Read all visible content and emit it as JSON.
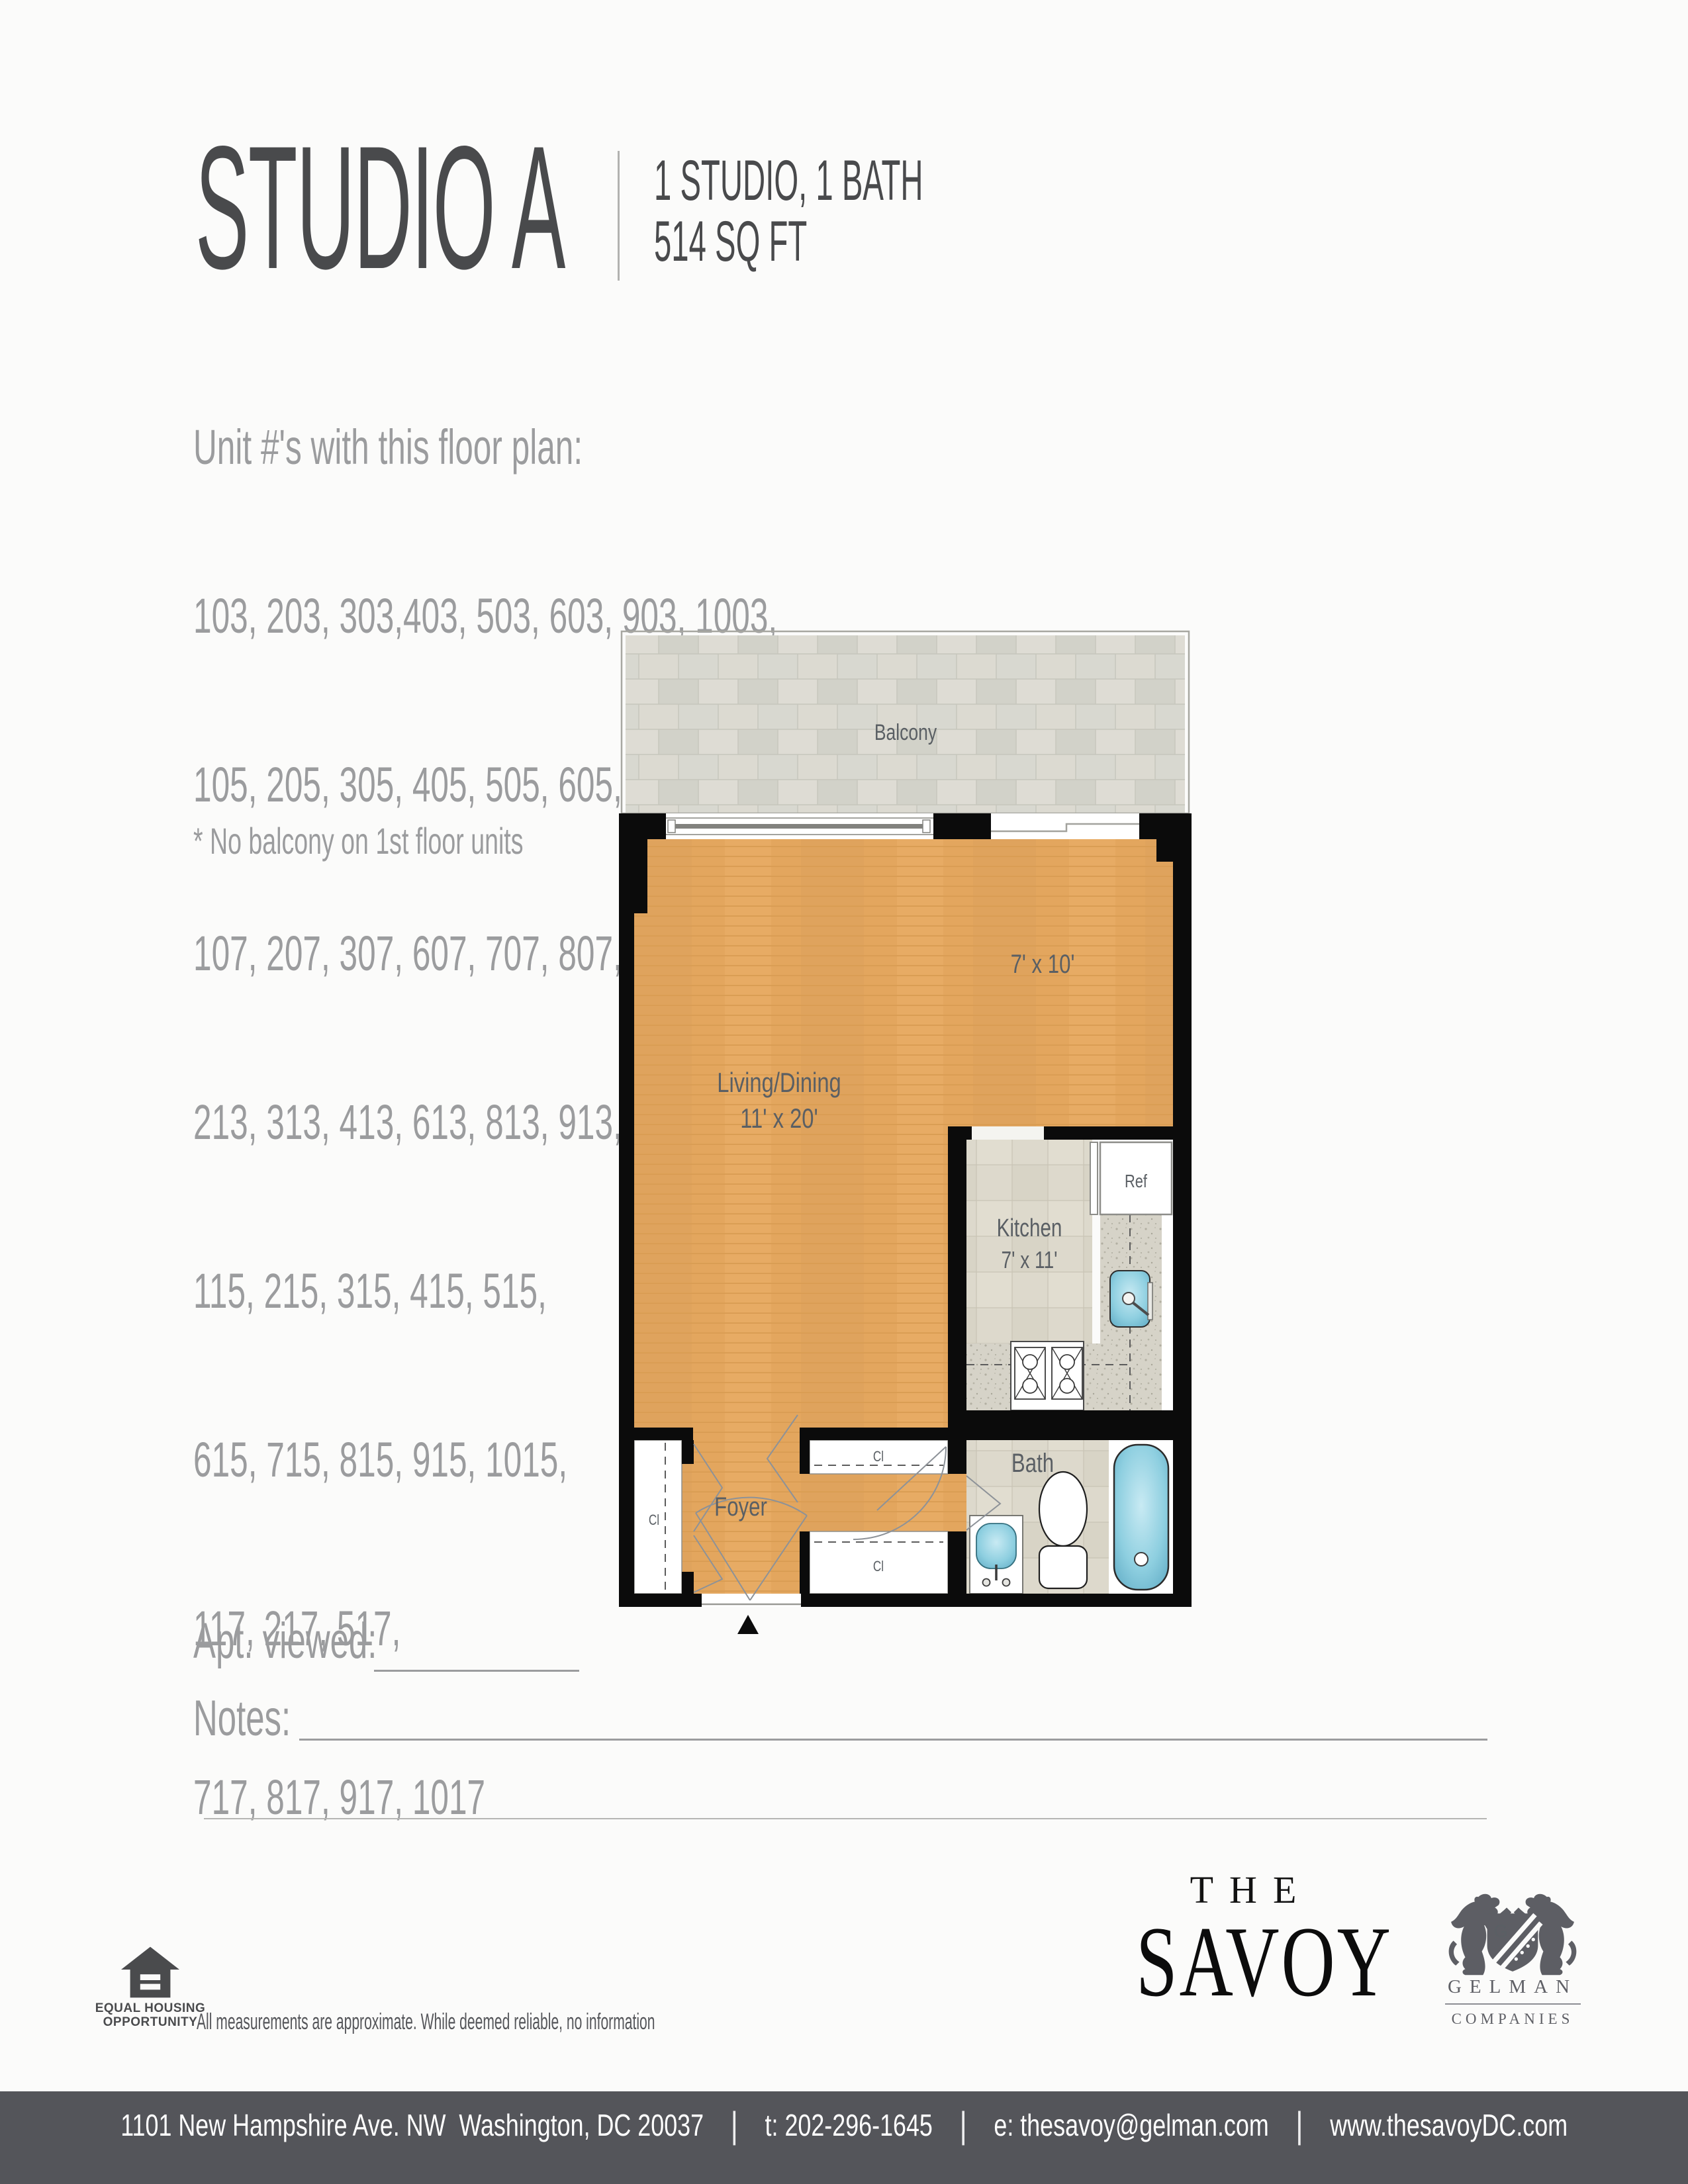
{
  "header": {
    "title": "STUDIO A",
    "spec_line1": "1 STUDIO, 1 BATH",
    "spec_line2": "514 SQ FT"
  },
  "units": {
    "heading": "Unit #'s with this floor plan:",
    "lines": [
      "103, 203, 303,403, 503, 603, 903, 1003,",
      "105, 205, 305, 405, 505, 605, 705, 805, 1005,",
      "107, 207, 307, 607, 707, 807, 907, 1007,",
      "213, 313, 413, 613, 813, 913, 1013,",
      "115, 215, 315, 415, 515,",
      "615, 715, 815, 915, 1015,",
      "117, 217, 517,",
      "717, 817, 917, 1017"
    ],
    "note": "* No balcony on 1st floor units"
  },
  "plan": {
    "balcony": "Balcony",
    "living": "Living/Dining",
    "living_dim": "11' x 20'",
    "alcove_dim": "7' x 10'",
    "kitchen": "Kitchen",
    "kitchen_dim": "7' x 11'",
    "ref": "Ref",
    "bath": "Bath",
    "foyer": "Foyer",
    "closet": "Cl",
    "colors": {
      "wall": "#0b0b0b",
      "wood": "#e3a65e",
      "tile": "#ddd9cc",
      "balcony_tile": "#d8d8d0",
      "granite": "#d6d3c8",
      "fixture_blue": "#8ecfe0"
    }
  },
  "form": {
    "apt_viewed": "Apt. viewed:",
    "notes": "Notes:"
  },
  "eho": {
    "line1": "EQUAL HOUSING",
    "line2": "OPPORTUNITY"
  },
  "disclaimer": {
    "line1": "All measurements are approximate. While deemed reliable, no information",
    "line2": "on these floor plans should be relied upon without independent verification."
  },
  "savoy": {
    "the": "THE",
    "name": "SAVOY"
  },
  "gelman": {
    "initial": "G",
    "name": "GELMAN",
    "sub": "COMPANIES"
  },
  "footer": {
    "address": "1101 New Hampshire Ave. NW  Washington, DC 20037",
    "phone": "t: 202-296-1645",
    "email": "e: thesavoy@gelman.com",
    "web": "www.thesavoyDC.com",
    "divider": "|"
  }
}
